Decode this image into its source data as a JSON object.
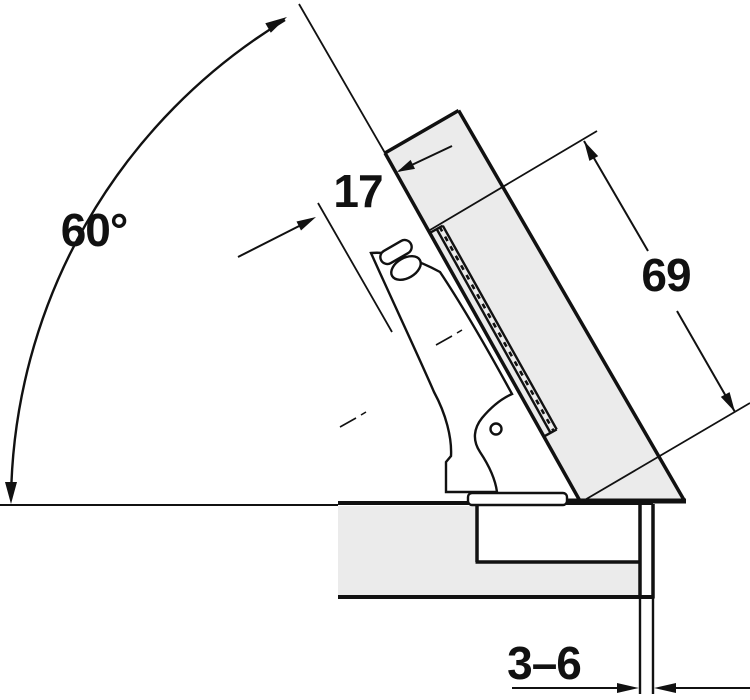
{
  "diagram": {
    "kind": "technical-drawing",
    "subject": "concealed hinge mounted on 60 degree inclined door over cabinet panel",
    "labels": {
      "opening_angle": "60°",
      "cup_distance": "17",
      "door_length": "69",
      "gap_range": "3–6"
    },
    "colors": {
      "line": "#111111",
      "panel_fill": "#ebebeb",
      "background": "#ffffff"
    }
  }
}
